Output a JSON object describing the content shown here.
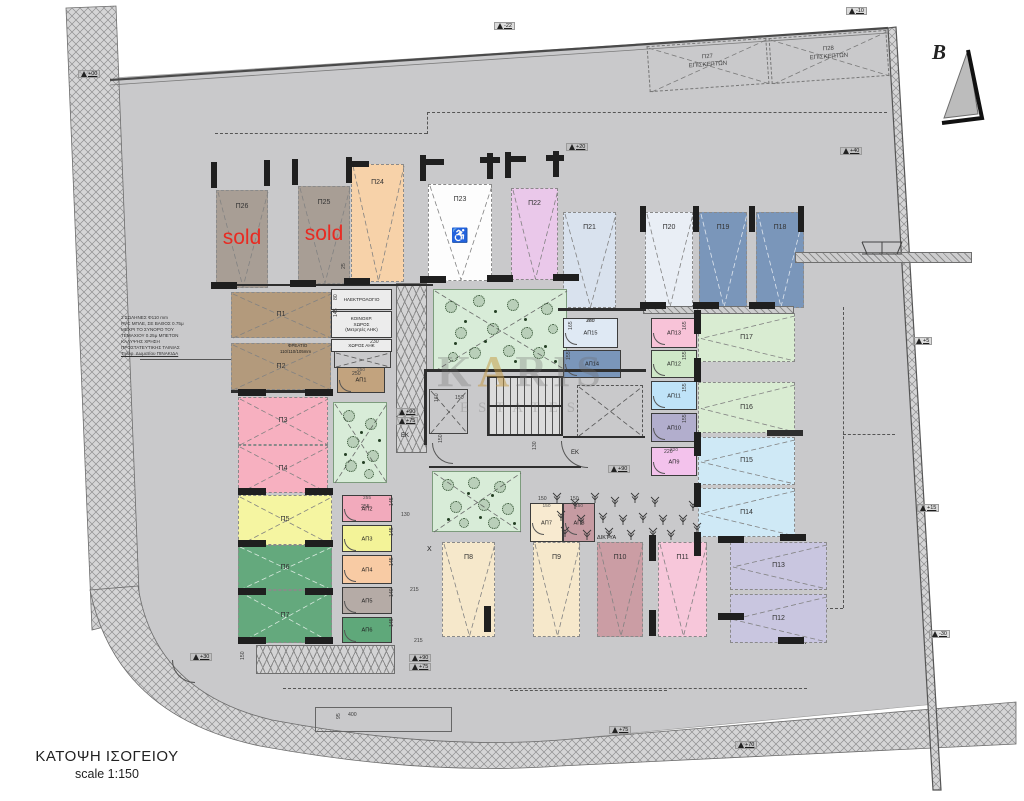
{
  "meta": {
    "title_line1": "ΚΑΤΟΨΗ ΙΣΟΓΕΙΟΥ",
    "title_line2": "scale 1:150",
    "north_label": "B",
    "sold_label": "sold",
    "handicap_symbol": "♿",
    "watermark_k": "K",
    "watermark_a": "A",
    "watermark_ris": "RIS",
    "watermark_line2": "ESTATES",
    "sold_color": "#e82b22",
    "site_color": "#c9c9cb"
  },
  "stalls": [
    {
      "label": "Π26",
      "x": 216,
      "y": 190,
      "w": 52,
      "h": 98,
      "color": "#a89e95",
      "orient": "v",
      "sold": true
    },
    {
      "label": "Π25",
      "x": 298,
      "y": 186,
      "w": 52,
      "h": 98,
      "color": "#a89e95",
      "orient": "v",
      "sold": true
    },
    {
      "label": "Π24",
      "x": 351,
      "y": 164,
      "w": 53,
      "h": 118,
      "color": "#f7d2a9",
      "orient": "v"
    },
    {
      "label": "Π23",
      "x": 428,
      "y": 184,
      "w": 64,
      "h": 97,
      "color": "#fdfdfd",
      "orient": "v",
      "handicap": true
    },
    {
      "label": "Π22",
      "x": 511,
      "y": 188,
      "w": 47,
      "h": 92,
      "color": "#eac8ea",
      "orient": "v"
    },
    {
      "label": "Π21",
      "x": 563,
      "y": 212,
      "w": 53,
      "h": 96,
      "color": "#d9e2ee",
      "orient": "v"
    },
    {
      "label": "Π20",
      "x": 645,
      "y": 212,
      "w": 48,
      "h": 96,
      "color": "#e9eef5",
      "orient": "v"
    },
    {
      "label": "Π19",
      "x": 699,
      "y": 212,
      "w": 48,
      "h": 96,
      "color": "#7a96ba",
      "orient": "v",
      "dark": true
    },
    {
      "label": "Π18",
      "x": 756,
      "y": 212,
      "w": 48,
      "h": 96,
      "color": "#7a96ba",
      "orient": "v",
      "dark": true
    },
    {
      "label": "Π17",
      "x": 698,
      "y": 313,
      "w": 97,
      "h": 49,
      "color": "#d9ecd2",
      "orient": "h"
    },
    {
      "label": "Π16",
      "x": 698,
      "y": 382,
      "w": 97,
      "h": 51,
      "color": "#d9ecd2",
      "orient": "h"
    },
    {
      "label": "Π15",
      "x": 698,
      "y": 437,
      "w": 97,
      "h": 48,
      "color": "#cfe9f6",
      "orient": "h"
    },
    {
      "label": "Π14",
      "x": 698,
      "y": 488,
      "w": 97,
      "h": 49,
      "color": "#cfe9f6",
      "orient": "h"
    },
    {
      "label": "Π13",
      "x": 730,
      "y": 542,
      "w": 97,
      "h": 48,
      "color": "#c9c6e0",
      "orient": "h"
    },
    {
      "label": "Π12",
      "x": 730,
      "y": 594,
      "w": 97,
      "h": 49,
      "color": "#c9c6e0",
      "orient": "h"
    },
    {
      "label": "Π11",
      "x": 658,
      "y": 542,
      "w": 49,
      "h": 95,
      "color": "#f7c7da",
      "orient": "v"
    },
    {
      "label": "Π10",
      "x": 597,
      "y": 542,
      "w": 46,
      "h": 95,
      "color": "#cb9da4",
      "orient": "v"
    },
    {
      "label": "Π9",
      "x": 533,
      "y": 542,
      "w": 47,
      "h": 95,
      "color": "#f6e8cb",
      "orient": "v"
    },
    {
      "label": "Π8",
      "x": 442,
      "y": 542,
      "w": 53,
      "h": 95,
      "color": "#f6e8cb",
      "orient": "v"
    },
    {
      "label": "Π7",
      "x": 238,
      "y": 590,
      "w": 94,
      "h": 53,
      "color": "#64a97d",
      "orient": "x",
      "dark": true
    },
    {
      "label": "Π6",
      "x": 238,
      "y": 545,
      "w": 94,
      "h": 45,
      "color": "#64a97d",
      "orient": "x",
      "dark": true
    },
    {
      "label": "Π5",
      "x": 238,
      "y": 495,
      "w": 94,
      "h": 50,
      "color": "#f5f5a1",
      "orient": "x"
    },
    {
      "label": "Π4",
      "x": 238,
      "y": 445,
      "w": 90,
      "h": 48,
      "color": "#f7b0c0",
      "orient": "x"
    },
    {
      "label": "Π3",
      "x": 238,
      "y": 397,
      "w": 90,
      "h": 48,
      "color": "#f7b0c0",
      "orient": "x"
    },
    {
      "label": "Π2",
      "x": 231,
      "y": 343,
      "w": 100,
      "h": 47,
      "color": "#b39a7c",
      "orient": "x"
    },
    {
      "label": "Π1",
      "x": 231,
      "y": 292,
      "w": 100,
      "h": 46,
      "color": "#b39a7c",
      "orient": "x"
    }
  ],
  "visitor_stalls": [
    {
      "label": "Π27",
      "label2": "ΕΠΙΣΚΕΠΤΩΝ",
      "x": 648,
      "y": 42,
      "w": 120,
      "h": 46,
      "rot": -4
    },
    {
      "label": "Π28",
      "label2": "ΕΠΙΣΚΕΠΤΩΝ",
      "x": 770,
      "y": 34,
      "w": 118,
      "h": 46,
      "rot": -4
    }
  ],
  "storages": [
    {
      "label": "ΑΠ15",
      "x": 563,
      "y": 318,
      "w": 55,
      "h": 30,
      "color": "#dfe9f4",
      "dim": "280"
    },
    {
      "label": "ΑΠ14",
      "x": 563,
      "y": 350,
      "w": 58,
      "h": 28,
      "color": "#7a96ba"
    },
    {
      "label": "ΑΠ13",
      "x": 651,
      "y": 318,
      "w": 46,
      "h": 30,
      "color": "#f8c3d8"
    },
    {
      "label": "ΑΠ12",
      "x": 651,
      "y": 350,
      "w": 46,
      "h": 28,
      "color": "#cfe8c8"
    },
    {
      "label": "ΑΠ11",
      "x": 651,
      "y": 381,
      "w": 46,
      "h": 29,
      "color": "#bfe3f8"
    },
    {
      "label": "ΑΠ10",
      "x": 651,
      "y": 413,
      "w": 46,
      "h": 29,
      "color": "#b2aecd"
    },
    {
      "label": "ΑΠ9",
      "x": 651,
      "y": 447,
      "w": 46,
      "h": 29,
      "color": "#f3c2ec",
      "dim": "220"
    },
    {
      "label": "ΑΠ8",
      "x": 563,
      "y": 503,
      "w": 32,
      "h": 39,
      "color": "#c69ba2",
      "dim": "150"
    },
    {
      "label": "ΑΠ7",
      "x": 530,
      "y": 503,
      "w": 33,
      "h": 39,
      "color": "#f8ead0",
      "dim": "150"
    },
    {
      "label": "ΑΠ6",
      "x": 342,
      "y": 617,
      "w": 50,
      "h": 26,
      "color": "#5fa87a"
    },
    {
      "label": "ΑΠ5",
      "x": 342,
      "y": 587,
      "w": 50,
      "h": 27,
      "color": "#b5aba6"
    },
    {
      "label": "ΑΠ4",
      "x": 342,
      "y": 555,
      "w": 50,
      "h": 29,
      "color": "#f8cba4"
    },
    {
      "label": "ΑΠ3",
      "x": 342,
      "y": 525,
      "w": 50,
      "h": 27,
      "color": "#f3f398"
    },
    {
      "label": "ΑΠ2",
      "x": 342,
      "y": 495,
      "w": 50,
      "h": 27,
      "color": "#f2aabc",
      "dim": "255"
    },
    {
      "label": "ΑΠ1",
      "x": 337,
      "y": 367,
      "w": 48,
      "h": 26,
      "color": "#c2a37e",
      "dim": "250"
    }
  ],
  "rooms": [
    {
      "lines": [
        "ΗΛΕΚΤΡΟΛΟΓΙΟ"
      ],
      "x": 331,
      "y": 289,
      "w": 61,
      "h": 21
    },
    {
      "lines": [
        "ΚΟΙΝΟΧΡ.",
        "ΧΩΡΟΣ",
        "(Μετρητές ΑΗΚ)"
      ],
      "x": 331,
      "y": 311,
      "w": 61,
      "h": 27
    },
    {
      "lines": [
        "ΧΩΡΟΣ ΑΗΚ"
      ],
      "x": 331,
      "y": 339,
      "w": 61,
      "h": 13
    }
  ],
  "note": {
    "x": 121,
    "y": 315,
    "lines": [
      "2 ΣΩΛΗΝΕΣ Φ110 mm",
      "PVC ΜΠΛΕ, ΣΕ ΒΑΘΟΣ 0.75μ",
      "ΜΕΧΡΙ ΤΟ ΣΥΝΟΡΟ ΤΟΥ",
      "ΤΕΜΑΧΙΟΥ 0.25μ ΜΠΕΤΟΝ",
      "ΚΑΛΥΨΗΣ ΧΡΗΣΗ",
      "ΠΡΟΣΤΑΤΕΥΤΙΚΗΣ ΤΑΙΝΙΑΣ",
      "Τηλεφ. Δωματίου ΠΙΝΑΚΙΔΑ"
    ]
  },
  "texts": [
    {
      "t": "ΕΚ",
      "x": 401,
      "y": 433,
      "fs": 6
    },
    {
      "t": "ΕΚ",
      "x": 571,
      "y": 450,
      "fs": 6
    },
    {
      "t": "X",
      "x": 427,
      "y": 546,
      "fs": 7
    },
    {
      "t": "ΔΙΚΤΥΑ",
      "x": 597,
      "y": 535,
      "fs": 5.5
    },
    {
      "t": "ΦΡΕΑΤΙΟ",
      "x": 288,
      "y": 343,
      "fs": 4.4
    },
    {
      "t": "110/110/105mm",
      "x": 280,
      "y": 349,
      "fs": 4.4
    }
  ],
  "levels": [
    {
      "t": "+00",
      "x": 78,
      "y": 70
    },
    {
      "t": "-22",
      "x": 494,
      "y": 22
    },
    {
      "t": "-10",
      "x": 846,
      "y": 7
    },
    {
      "t": "+20",
      "x": 566,
      "y": 143
    },
    {
      "t": "+40",
      "x": 840,
      "y": 147
    },
    {
      "t": "+5",
      "x": 913,
      "y": 337
    },
    {
      "t": "+15",
      "x": 917,
      "y": 504
    },
    {
      "t": "-30",
      "x": 929,
      "y": 630
    },
    {
      "t": "+30",
      "x": 190,
      "y": 653
    },
    {
      "t": "+90",
      "x": 396,
      "y": 408
    },
    {
      "t": "+75",
      "x": 396,
      "y": 417
    },
    {
      "t": "+90",
      "x": 608,
      "y": 465
    },
    {
      "t": "+90",
      "x": 409,
      "y": 654
    },
    {
      "t": "+75",
      "x": 409,
      "y": 663
    },
    {
      "t": "+75",
      "x": 609,
      "y": 726
    },
    {
      "t": "+70",
      "x": 735,
      "y": 741
    }
  ],
  "dims": [
    {
      "t": "80",
      "x": 333,
      "y": 300,
      "v": 1
    },
    {
      "t": "145",
      "x": 333,
      "y": 317,
      "v": 1
    },
    {
      "t": "230",
      "x": 370,
      "y": 339
    },
    {
      "t": "250",
      "x": 352,
      "y": 371
    },
    {
      "t": "150",
      "x": 455,
      "y": 395
    },
    {
      "t": "160",
      "x": 434,
      "y": 402,
      "v": 1
    },
    {
      "t": "150",
      "x": 438,
      "y": 443,
      "v": 1
    },
    {
      "t": "130",
      "x": 532,
      "y": 450,
      "v": 1
    },
    {
      "t": "280",
      "x": 586,
      "y": 318
    },
    {
      "t": "165",
      "x": 568,
      "y": 330,
      "v": 1
    },
    {
      "t": "155",
      "x": 566,
      "y": 360,
      "v": 1
    },
    {
      "t": "165",
      "x": 682,
      "y": 330,
      "v": 1
    },
    {
      "t": "155",
      "x": 682,
      "y": 360,
      "v": 1
    },
    {
      "t": "155",
      "x": 682,
      "y": 392,
      "v": 1
    },
    {
      "t": "155",
      "x": 682,
      "y": 423,
      "v": 1
    },
    {
      "t": "220",
      "x": 664,
      "y": 449
    },
    {
      "t": "150",
      "x": 538,
      "y": 496
    },
    {
      "t": "150",
      "x": 570,
      "y": 496
    },
    {
      "t": "255",
      "x": 361,
      "y": 504
    },
    {
      "t": "145",
      "x": 389,
      "y": 506,
      "v": 1
    },
    {
      "t": "145",
      "x": 389,
      "y": 536,
      "v": 1
    },
    {
      "t": "145",
      "x": 389,
      "y": 566,
      "v": 1
    },
    {
      "t": "140",
      "x": 389,
      "y": 597,
      "v": 1
    },
    {
      "t": "145",
      "x": 389,
      "y": 627,
      "v": 1
    },
    {
      "t": "130",
      "x": 401,
      "y": 512
    },
    {
      "t": "215",
      "x": 410,
      "y": 587
    },
    {
      "t": "215",
      "x": 414,
      "y": 638
    },
    {
      "t": "400",
      "x": 348,
      "y": 712
    },
    {
      "t": "150",
      "x": 240,
      "y": 660,
      "v": 1
    },
    {
      "t": "95",
      "x": 336,
      "y": 719,
      "v": 1
    },
    {
      "t": "25",
      "x": 341,
      "y": 269,
      "v": 1
    }
  ],
  "greens": [
    {
      "x": 433,
      "y": 289,
      "w": 134,
      "h": 82,
      "trees": [
        [
          16,
          16,
          5
        ],
        [
          44,
          10,
          5
        ],
        [
          78,
          14,
          5
        ],
        [
          112,
          18,
          5
        ],
        [
          26,
          42,
          5
        ],
        [
          58,
          38,
          5
        ],
        [
          92,
          42,
          5
        ],
        [
          118,
          38,
          4
        ],
        [
          40,
          62,
          5
        ],
        [
          74,
          60,
          5
        ],
        [
          104,
          62,
          5
        ],
        [
          18,
          66,
          4
        ]
      ],
      "dots": [
        [
          60,
          20
        ],
        [
          90,
          28
        ],
        [
          30,
          30
        ],
        [
          110,
          55
        ],
        [
          50,
          50
        ],
        [
          80,
          70
        ],
        [
          20,
          52
        ],
        [
          120,
          70
        ]
      ]
    },
    {
      "x": 333,
      "y": 402,
      "w": 54,
      "h": 81,
      "trees": [
        [
          14,
          12,
          5
        ],
        [
          36,
          20,
          5
        ],
        [
          18,
          38,
          5
        ],
        [
          38,
          52,
          5
        ],
        [
          16,
          62,
          5
        ],
        [
          34,
          70,
          4
        ]
      ],
      "dots": [
        [
          26,
          28
        ],
        [
          28,
          58
        ],
        [
          44,
          36
        ],
        [
          10,
          50
        ]
      ]
    },
    {
      "x": 432,
      "y": 471,
      "w": 89,
      "h": 61,
      "trees": [
        [
          14,
          12,
          5
        ],
        [
          40,
          10,
          5
        ],
        [
          66,
          14,
          5
        ],
        [
          22,
          34,
          5
        ],
        [
          50,
          32,
          5
        ],
        [
          74,
          36,
          5
        ],
        [
          30,
          50,
          4
        ],
        [
          60,
          50,
          5
        ]
      ],
      "dots": [
        [
          34,
          20
        ],
        [
          58,
          22
        ],
        [
          80,
          50
        ],
        [
          14,
          46
        ],
        [
          46,
          44
        ]
      ]
    }
  ],
  "veg": [
    [
      550,
      490
    ],
    [
      568,
      496
    ],
    [
      588,
      490
    ],
    [
      608,
      494
    ],
    [
      628,
      490
    ],
    [
      648,
      494
    ],
    [
      554,
      508
    ],
    [
      574,
      512
    ],
    [
      596,
      510
    ],
    [
      616,
      512
    ],
    [
      636,
      510
    ],
    [
      656,
      512
    ],
    [
      558,
      524
    ],
    [
      580,
      527
    ],
    [
      602,
      525
    ],
    [
      624,
      527
    ],
    [
      646,
      525
    ],
    [
      664,
      527
    ],
    [
      676,
      512
    ],
    [
      686,
      498
    ],
    [
      690,
      520
    ]
  ],
  "structure": {
    "stairs": {
      "x": 487,
      "y": 376,
      "w": 76,
      "h": 60
    },
    "xboxes": [
      {
        "x": 429,
        "y": 389,
        "w": 39,
        "h": 45,
        "dashed": false
      },
      {
        "x": 577,
        "y": 385,
        "w": 66,
        "h": 52,
        "dashed": true
      },
      {
        "x": 334,
        "y": 351,
        "w": 57,
        "h": 17,
        "dashed": false
      }
    ],
    "walls": [
      [
        213,
        284,
        220,
        2
      ],
      [
        558,
        308,
        88,
        3
      ],
      [
        231,
        390,
        102,
        3
      ],
      [
        424,
        369,
        222,
        3
      ],
      [
        424,
        369,
        3,
        76
      ],
      [
        563,
        436,
        82,
        2
      ],
      [
        429,
        466,
        152,
        2
      ],
      [
        767,
        430,
        36,
        6
      ]
    ],
    "columns": [
      [
        211,
        162,
        6,
        26
      ],
      [
        264,
        160,
        6,
        26
      ],
      [
        292,
        159,
        6,
        26
      ],
      [
        346,
        157,
        6,
        26
      ],
      [
        420,
        155,
        6,
        26
      ],
      [
        487,
        153,
        6,
        26
      ],
      [
        505,
        152,
        6,
        26
      ],
      [
        553,
        151,
        6,
        26
      ],
      [
        349,
        161,
        20,
        6
      ],
      [
        424,
        159,
        20,
        6
      ],
      [
        480,
        157,
        20,
        6
      ],
      [
        508,
        156,
        18,
        6
      ],
      [
        546,
        155,
        18,
        6
      ],
      [
        211,
        282,
        26,
        7
      ],
      [
        290,
        280,
        26,
        7
      ],
      [
        344,
        278,
        26,
        7
      ],
      [
        420,
        276,
        26,
        7
      ],
      [
        487,
        275,
        26,
        7
      ],
      [
        553,
        274,
        26,
        7
      ],
      [
        640,
        206,
        6,
        26
      ],
      [
        693,
        206,
        6,
        26
      ],
      [
        749,
        206,
        6,
        26
      ],
      [
        798,
        206,
        6,
        26
      ],
      [
        640,
        302,
        26,
        7
      ],
      [
        693,
        302,
        26,
        7
      ],
      [
        749,
        302,
        26,
        7
      ],
      [
        238,
        389,
        28,
        7
      ],
      [
        238,
        488,
        28,
        7
      ],
      [
        238,
        540,
        28,
        7
      ],
      [
        238,
        588,
        28,
        7
      ],
      [
        238,
        637,
        28,
        7
      ],
      [
        305,
        389,
        28,
        7
      ],
      [
        305,
        488,
        28,
        7
      ],
      [
        305,
        540,
        28,
        7
      ],
      [
        305,
        588,
        28,
        7
      ],
      [
        305,
        637,
        28,
        7
      ],
      [
        694,
        310,
        7,
        24
      ],
      [
        694,
        358,
        7,
        24
      ],
      [
        694,
        432,
        7,
        24
      ],
      [
        694,
        483,
        7,
        24
      ],
      [
        694,
        532,
        7,
        24
      ],
      [
        484,
        606,
        7,
        26
      ],
      [
        649,
        535,
        7,
        26
      ],
      [
        649,
        610,
        7,
        26
      ],
      [
        718,
        536,
        26,
        7
      ],
      [
        718,
        613,
        26,
        7
      ],
      [
        778,
        637,
        26,
        7
      ],
      [
        780,
        534,
        26,
        7
      ]
    ],
    "hatches": [
      {
        "x": 643,
        "y": 306,
        "w": 151,
        "h": 8,
        "chev": false
      },
      {
        "x": 795,
        "y": 252,
        "w": 177,
        "h": 11,
        "chev": false
      },
      {
        "x": 396,
        "y": 283,
        "w": 31,
        "h": 170,
        "chev": true
      },
      {
        "x": 256,
        "y": 645,
        "w": 139,
        "h": 29,
        "chev": true
      }
    ],
    "dashes": [
      [
        215,
        133,
        212,
        0
      ],
      [
        427,
        112,
        460,
        0
      ],
      [
        427,
        112,
        0,
        22
      ],
      [
        843,
        307,
        0,
        301
      ],
      [
        805,
        608,
        38,
        0
      ],
      [
        805,
        608,
        0,
        36
      ],
      [
        283,
        688,
        524,
        0
      ],
      [
        843,
        434,
        52,
        0
      ],
      [
        510,
        690,
        157,
        0
      ]
    ],
    "slines": [
      [
        140,
        359,
        92
      ]
    ],
    "arcs": [
      [
        561,
        441,
        26
      ],
      [
        172,
        660,
        22
      ],
      [
        432,
        443,
        20
      ]
    ],
    "orects": [
      [
        315,
        707,
        137,
        25
      ]
    ]
  }
}
